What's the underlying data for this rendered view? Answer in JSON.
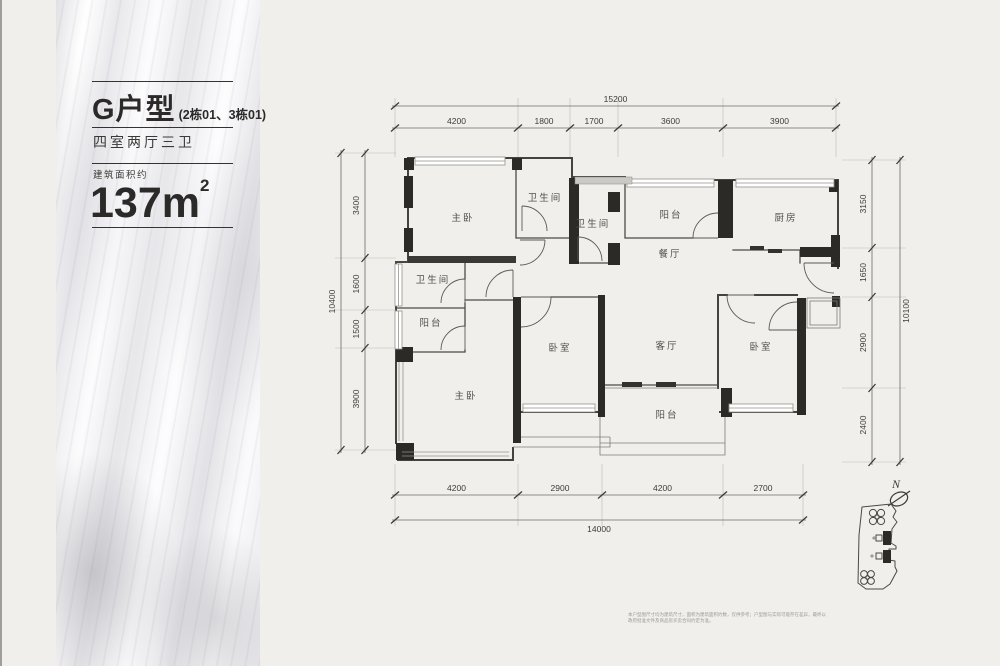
{
  "panel": {
    "type_name": "G户型",
    "type_sub": "(2栋01、3栋01)",
    "layout": "四室两厅三卫",
    "area_label": "建筑面积约",
    "area_value": "137m",
    "area_sup": "2"
  },
  "plan": {
    "compass_label": "N",
    "rooms": [
      {
        "label": "主卧",
        "x": 463,
        "y": 221
      },
      {
        "label": "卫生间",
        "x": 545,
        "y": 201
      },
      {
        "label": "卫生间",
        "x": 593,
        "y": 227
      },
      {
        "label": "阳台",
        "x": 671,
        "y": 218
      },
      {
        "label": "厨房",
        "x": 786,
        "y": 221
      },
      {
        "label": "餐厅",
        "x": 670,
        "y": 257
      },
      {
        "label": "卫生间",
        "x": 433,
        "y": 283
      },
      {
        "label": "阳台",
        "x": 431,
        "y": 326
      },
      {
        "label": "卧室",
        "x": 560,
        "y": 351
      },
      {
        "label": "客厅",
        "x": 667,
        "y": 349
      },
      {
        "label": "卧室",
        "x": 761,
        "y": 350
      },
      {
        "label": "主卧",
        "x": 466,
        "y": 399
      },
      {
        "label": "阳台",
        "x": 667,
        "y": 418
      }
    ],
    "dimensions": [
      {
        "id": "top-total",
        "orient": "h",
        "pos": 106,
        "label_off": -4,
        "items": [
          {
            "v": "15200",
            "a": 395,
            "b": 836
          }
        ]
      },
      {
        "id": "top-segments",
        "orient": "h",
        "pos": 128,
        "label_off": -4,
        "items": [
          {
            "v": "4200",
            "a": 395,
            "b": 518
          },
          {
            "v": "1800",
            "a": 518,
            "b": 570
          },
          {
            "v": "1700",
            "a": 570,
            "b": 618
          },
          {
            "v": "3600",
            "a": 618,
            "b": 723
          },
          {
            "v": "3900",
            "a": 723,
            "b": 836
          }
        ]
      },
      {
        "id": "left-total",
        "orient": "v",
        "pos": 341,
        "label_off": -6,
        "items": [
          {
            "v": "10400",
            "a": 153,
            "b": 450
          }
        ]
      },
      {
        "id": "left-segments",
        "orient": "v",
        "pos": 365,
        "label_off": -6,
        "items": [
          {
            "v": "3400",
            "a": 153,
            "b": 258
          },
          {
            "v": "1600",
            "a": 258,
            "b": 310
          },
          {
            "v": "1500",
            "a": 310,
            "b": 348
          },
          {
            "v": "3900",
            "a": 348,
            "b": 450
          }
        ]
      },
      {
        "id": "right-segments",
        "orient": "v",
        "pos": 872,
        "label_off": -6,
        "items": [
          {
            "v": "3150",
            "a": 160,
            "b": 248
          },
          {
            "v": "1650",
            "a": 248,
            "b": 297
          },
          {
            "v": "2900",
            "a": 297,
            "b": 388
          },
          {
            "v": "2400",
            "a": 388,
            "b": 462
          }
        ]
      },
      {
        "id": "right-total",
        "orient": "v",
        "pos": 900,
        "label_off": 9,
        "items": [
          {
            "v": "10100",
            "a": 160,
            "b": 462
          }
        ]
      },
      {
        "id": "bottom-segments",
        "orient": "h",
        "pos": 495,
        "label_off": -4,
        "items": [
          {
            "v": "4200",
            "a": 395,
            "b": 518
          },
          {
            "v": "2900",
            "a": 518,
            "b": 602
          },
          {
            "v": "4200",
            "a": 602,
            "b": 723
          },
          {
            "v": "2700",
            "a": 723,
            "b": 803
          }
        ]
      },
      {
        "id": "bottom-total",
        "orient": "h",
        "pos": 520,
        "label_off": 12,
        "items": [
          {
            "v": "14000",
            "a": 395,
            "b": 803
          }
        ]
      }
    ],
    "witness_lines": [
      {
        "xs": [
          395,
          518,
          570,
          618,
          723,
          836
        ],
        "y1": 98,
        "y2": 157
      },
      {
        "xs": [
          395,
          518,
          602,
          723,
          803
        ],
        "y1": 464,
        "y2": 526
      },
      {
        "ys": [
          153,
          258,
          310,
          348,
          450
        ],
        "x1": 335,
        "x2": 396
      },
      {
        "ys": [
          160,
          248,
          297,
          388,
          462
        ],
        "x1": 842,
        "x2": 906
      }
    ]
  },
  "footer": {
    "disclaimer": "本户型图尺寸均为建筑尺寸，面积为建筑面积约数，仅供参考；户型图与实际可能存在差异，最终以政府批准文件及商品房买卖合同约定为准。"
  },
  "colors": {
    "background": "#f1efeb",
    "wall_black": "#2b2a27",
    "line": "#45433e",
    "marble_gray": "#cfcfd5"
  }
}
